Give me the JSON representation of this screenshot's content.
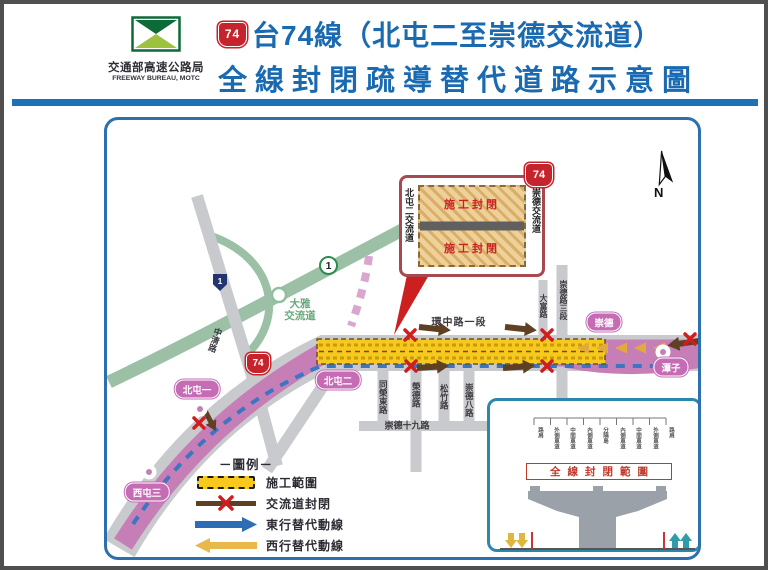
{
  "header": {
    "agency_name": "交通部高速公路局",
    "agency_name_en": "FREEWAY BUREAU, MOTC",
    "shield": "74",
    "title_line1": "台74線（北屯二至崇德交流道）",
    "title_line2": "全線封閉疏導替代道路示意圖"
  },
  "map": {
    "north_label": "N",
    "shields": {
      "national1": "1",
      "provincial1": "1",
      "route74": "74"
    },
    "callout": {
      "shield": "74",
      "left_label": "北屯二交流道",
      "right_label": "崇德交流道",
      "closure_upper": "施工封閉",
      "closure_lower": "施工封閉"
    },
    "interchange_daya": {
      "line1": "大雅",
      "line2": "交流道"
    },
    "badges": {
      "beitun1": "北屯一",
      "beitun2": "北屯二",
      "xitun3": "西屯三",
      "chongde": "崇德",
      "tanzi": "潭子"
    },
    "streets": {
      "huanzhong": "環中路一段",
      "zhongqing": "中清路",
      "dafu": "大富路",
      "chongde3": "崇德路三段",
      "tongrong": "同榮東路",
      "rongde": "榮德路",
      "songzhu": "松竹路",
      "chongde8": "崇德八路",
      "chongde19": "崇德十九路"
    }
  },
  "legend": {
    "title": "－圖例－",
    "items": [
      {
        "label": "施工範圍"
      },
      {
        "label": "交流道封閉"
      },
      {
        "label": "東行替代動線"
      },
      {
        "label": "西行替代動線"
      }
    ]
  },
  "inset": {
    "lanes": [
      "路肩",
      "外側車道",
      "中間車道",
      "內側車道",
      "分隔島",
      "內側車道",
      "中間車道",
      "外側車道",
      "路肩"
    ],
    "closure_label": "全線封閉範圍"
  },
  "colors": {
    "title_blue": "#1a6ab1",
    "map_border_blue": "#2e6fae",
    "route74_pink": "#c67fb6",
    "closure_yellow": "#f6c91c",
    "detour_east_blue": "#3a76c4",
    "detour_west_yellow": "#e2a93e",
    "freeway_green": "#9bc0a6",
    "closed_ramp_brown": "#5f4022",
    "x_red": "#d11d1d",
    "shield_red": "#c6242c"
  }
}
